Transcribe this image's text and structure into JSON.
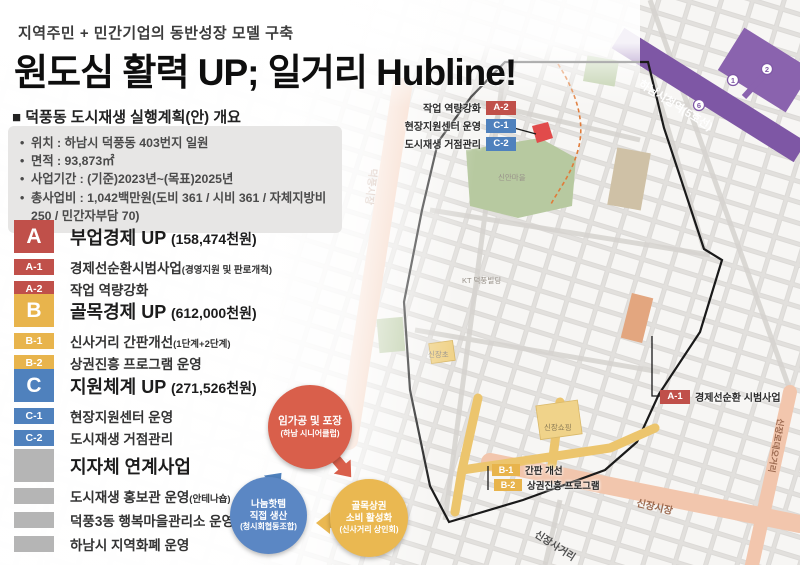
{
  "header": {
    "eyebrow": "지역주민 + 민간기업의 동반성장 모델 구축",
    "title": "원도심 활력 UP; 일거리 Hubline!"
  },
  "overview": {
    "heading": "■ 덕풍동 도시재생 실행계획(안) 개요",
    "items": [
      "위치 : 하남시 덕풍동 403번지 일원",
      "면적 : 93,873㎡",
      "사업기간 : (기준)2023년~(목표)2025년",
      "총사업비 : 1,042백만원(도비 361 / 시비 361 / 자체지방비 250 / 민간자부담 70)"
    ]
  },
  "sections": [
    {
      "code": "A",
      "title": "부업경제 UP",
      "budget": "(158,474천원)",
      "color": "#c0504a",
      "items": [
        {
          "code": "A-1",
          "label": "경제선순환시범사업",
          "note": "(경영지원 및 판로개척)"
        },
        {
          "code": "A-2",
          "label": "작업 역량강화",
          "note": ""
        }
      ]
    },
    {
      "code": "B",
      "title": "골목경제 UP",
      "budget": "(612,000천원)",
      "color": "#e8b44c",
      "items": [
        {
          "code": "B-1",
          "label": "신사거리 간판개선",
          "note": "(1단계+2단계)"
        },
        {
          "code": "B-2",
          "label": "상권진흥 프로그램 운영",
          "note": ""
        }
      ]
    },
    {
      "code": "C",
      "title": "지원체계 UP",
      "budget": "(271,526천원)",
      "color": "#4f81bd",
      "items": [
        {
          "code": "C-1",
          "label": "현장지원센터 운영",
          "note": ""
        },
        {
          "code": "C-2",
          "label": "도시재생 거점관리",
          "note": ""
        }
      ]
    }
  ],
  "linked_projects": {
    "title": "지자체 연계사업",
    "color": "#b5b5b5",
    "items": [
      {
        "label": "도시재생 홍보관 운영",
        "note": "(안테나숍)"
      },
      {
        "label": "덕풍3동 행복마을관리소 운영",
        "note": ""
      },
      {
        "label": "하남시 지역화폐 운영",
        "note": ""
      }
    ]
  },
  "map": {
    "top_callouts": [
      {
        "code": "A-2",
        "label": "작업 역량강화"
      },
      {
        "code": "C-1",
        "label": "현장지원센터 운영"
      },
      {
        "code": "C-2",
        "label": "도시재생 거점관리"
      }
    ],
    "a1_callout": {
      "code": "A-1",
      "label": "경제선순환 시범사업"
    },
    "b_callouts": [
      {
        "code": "B-1",
        "label": "간판 개선"
      },
      {
        "code": "B-2",
        "label": "상권진흥 프로그램"
      }
    ],
    "roads": {
      "left_market": "덕풍시장",
      "bottom_market": "신장시장",
      "intersection": "신장사거리",
      "subway_line": "하남시청역(5호선)",
      "right_street": "신장로데오거리"
    },
    "pois": {
      "village": "신안마을",
      "kt": "KT 덕풍빌딩",
      "shopping": "신장쇼핑",
      "school": "신장초"
    },
    "subway_exits": [
      "1",
      "2",
      "6"
    ]
  },
  "cycle": {
    "top": {
      "lines": [
        "임가공 및 포장",
        "(하남 시니어클럽)"
      ],
      "color": "#d95f4b"
    },
    "left": {
      "lines": [
        "나눔핫템",
        "직접 생산",
        "(청시회협동조합)"
      ],
      "color": "#5b87c4"
    },
    "right": {
      "lines": [
        "골목상권",
        "소비 활성화",
        "(신사거리 상인회)"
      ],
      "color": "#eab851"
    }
  }
}
